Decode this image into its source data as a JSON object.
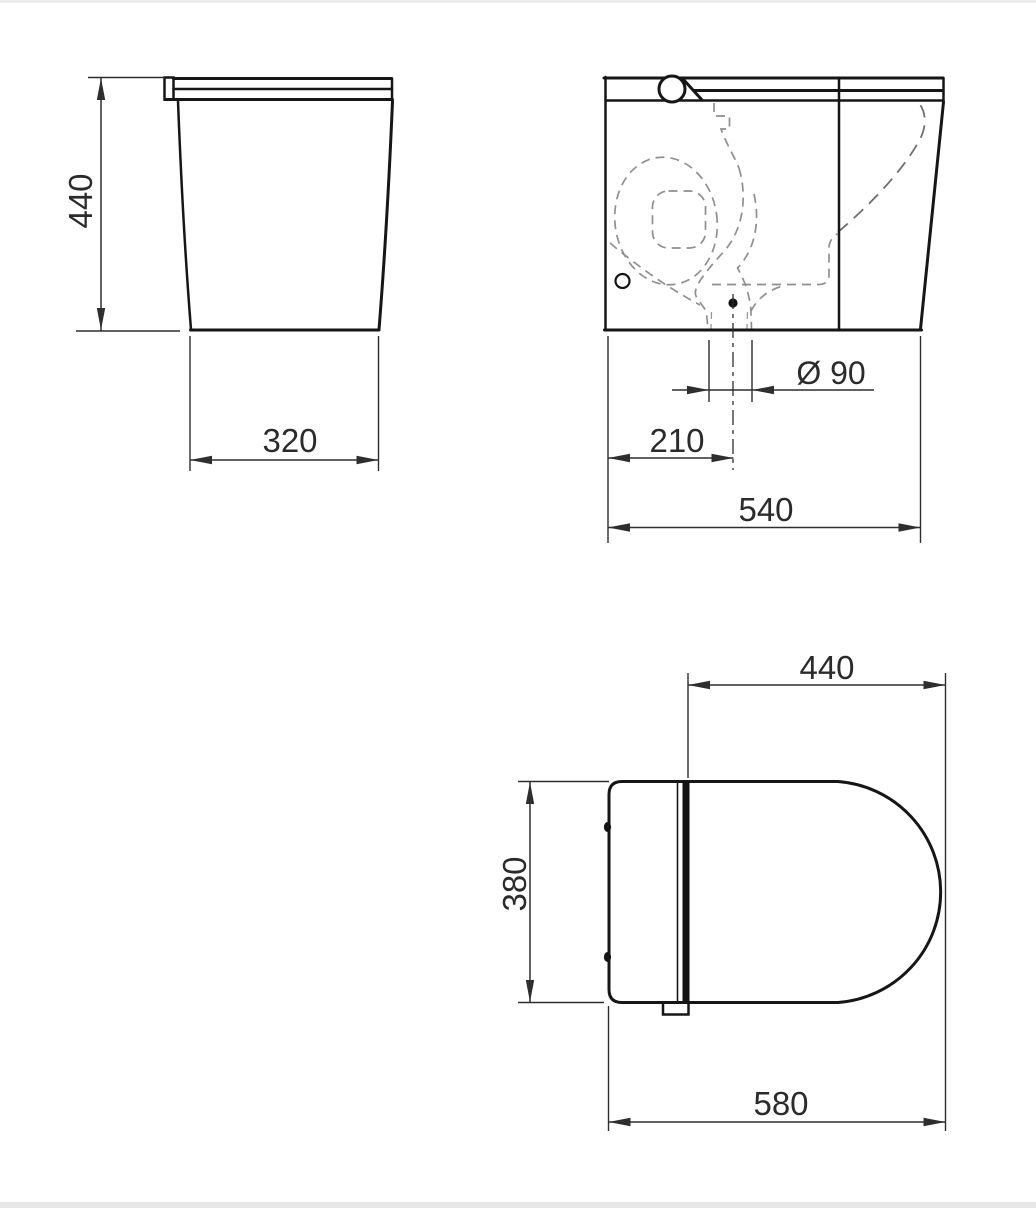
{
  "labels": {
    "side_height": "440",
    "side_base_depth": "320",
    "outlet_diameter": "Ø 90",
    "outlet_offset": "210",
    "front_width": "540",
    "seat_length": "440",
    "seat_back_width": "380",
    "total_depth": "580"
  },
  "colors": {
    "outline": "#161616",
    "dimension": "#2e2e2e",
    "hidden_line": "#8f8f8f",
    "background": "#ffffff",
    "edge_strip": "#e7e7e7"
  }
}
